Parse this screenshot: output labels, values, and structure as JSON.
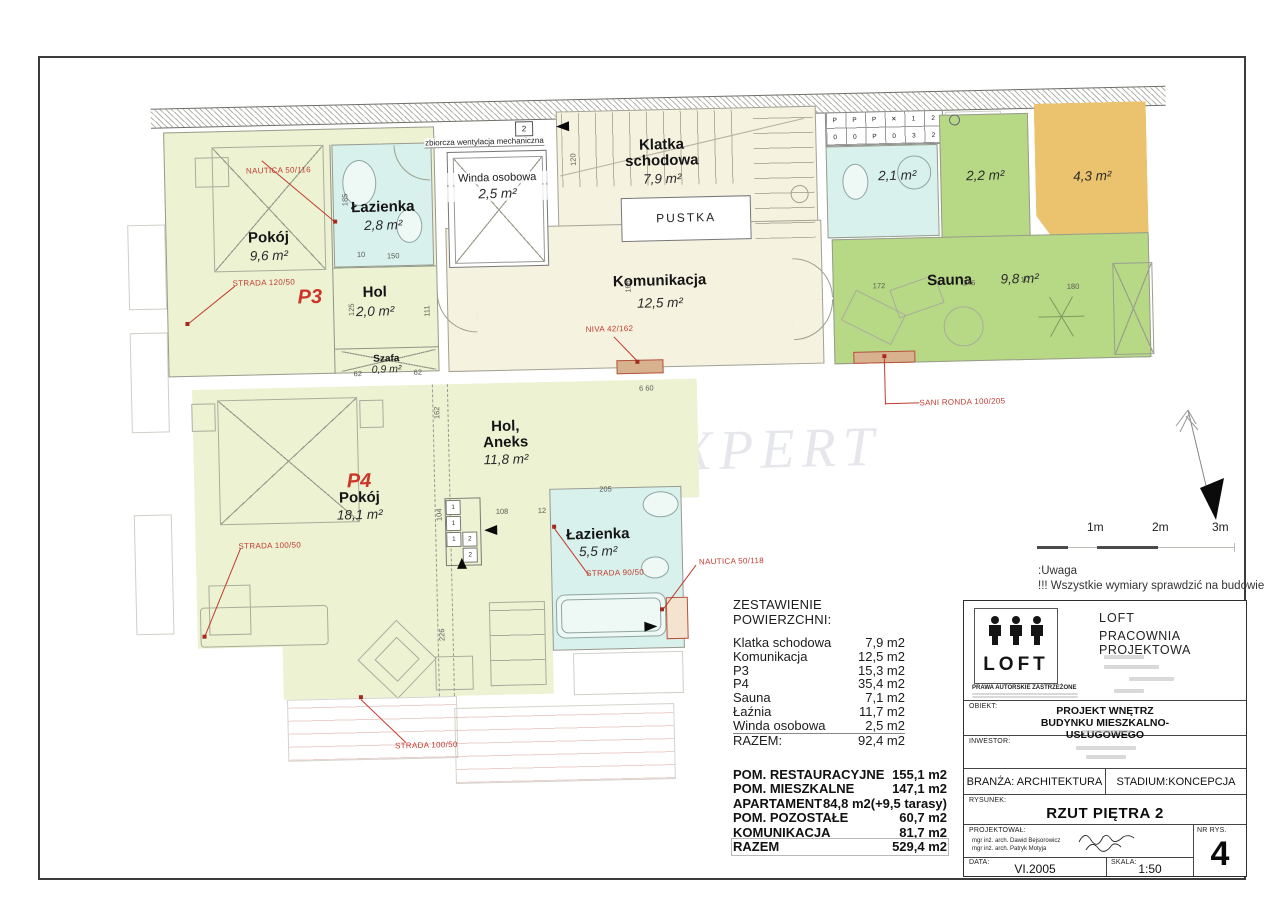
{
  "plan": {
    "watermark": "ON'S EXPERT",
    "watermark2": "S",
    "vent": {
      "label": "zbiorcza wentylacja mechaniczna",
      "box": "2"
    },
    "rooms": {
      "p3": {
        "code": "P3",
        "pokoj": {
          "name": "Pokój",
          "area": "9,6 m²"
        },
        "lazienka": {
          "name": "Łazienka",
          "area": "2,8 m²"
        },
        "hol": {
          "name": "Hol",
          "area": "2,0 m²"
        },
        "szafa": {
          "name": "Szafa",
          "area": "0,9 m²"
        }
      },
      "winda": {
        "name": "Winda osobowa",
        "area": "2,5 m²"
      },
      "klatka": {
        "name1": "Klatka",
        "name2": "schodowa",
        "area": "7,9 m²"
      },
      "pustka": "PUSTKA",
      "komunikacja": {
        "name": "Komunikacja",
        "area": "12,5 m²"
      },
      "wc": {
        "area": "2,1 m²"
      },
      "natryski": {
        "area": "2,2 m²"
      },
      "taras": {
        "area": "4,3 m²"
      },
      "sauna": {
        "name": "Sauna",
        "area": "9,8 m²"
      },
      "p4": {
        "code": "P4",
        "pokoj": {
          "name": "Pokój",
          "area": "18,1 m²"
        },
        "hol": {
          "name1": "Hol,",
          "name2": "Aneks",
          "area": "11,8 m²"
        },
        "lazienka": {
          "name": "Łazienka",
          "area": "5,5 m²"
        }
      }
    },
    "red_labels": [
      "NAUTICA 50/116",
      "STRADA 120/50",
      "NIVA 42/162",
      "SANI RONDA 100/205",
      "STRADA 100/50",
      "STRADA 90/50",
      "NAUTICA 50/118",
      "STRADA 100/50"
    ],
    "washer": [
      [
        "P",
        "P",
        "P",
        "✕",
        "1",
        "2"
      ],
      [
        "0",
        "0",
        "P",
        "0",
        "3",
        "2"
      ]
    ],
    "kitchen_cells": [
      "1",
      "1",
      "1",
      "2",
      "2"
    ],
    "dims": [
      "185",
      "150",
      "10",
      "125",
      "111",
      "62",
      "62",
      "120",
      "166",
      "172",
      "146",
      "10",
      "180",
      "162",
      "104",
      "226",
      "108",
      "12",
      "205",
      "6  60"
    ]
  },
  "scale_bar": {
    "labels": [
      "1m",
      "2m",
      "3m"
    ]
  },
  "note": {
    "line1": ":Uwaga",
    "line2": "!!! Wszystkie wymiary sprawdzić na budowie"
  },
  "areas_table": {
    "title": "ZESTAWIENIE POWIERZCHNI:",
    "rows": [
      {
        "label": "Klatka schodowa",
        "value": "7,9 m2"
      },
      {
        "label": "Komunikacja",
        "value": "12,5 m2"
      },
      {
        "label": "P3",
        "value": "15,3 m2"
      },
      {
        "label": "P4",
        "value": "35,4 m2"
      },
      {
        "label": "Sauna",
        "value": "7,1 m2"
      },
      {
        "label": "Łaźnia",
        "value": "11,7 m2"
      },
      {
        "label": "Winda osobowa",
        "value": "2,5 m2"
      },
      {
        "label": "RAZEM:",
        "value": "92,4 m2"
      }
    ]
  },
  "summary_table": {
    "rows": [
      {
        "label": "POM. RESTAURACYJNE",
        "value": "155,1 m2"
      },
      {
        "label": "POM. MIESZKALNE",
        "value": "147,1 m2"
      },
      {
        "label": "APARTAMENT",
        "value": "84,8 m2(+9,5 tarasy)"
      },
      {
        "label": "POM. POZOSTAŁE",
        "value": "60,7 m2"
      },
      {
        "label": "KOMUNIKACJA",
        "value": "81,7 m2"
      },
      {
        "label": "RAZEM",
        "value": "529,4 m2"
      }
    ]
  },
  "title_block": {
    "logo_text": "LOFT",
    "rights": "PRAWA AUTORSKIE ZASTRZEŻONE",
    "studio_line1": "LOFT",
    "studio_line2": "PRACOWNIA  PROJEKTOWA",
    "obiekt_label": "OBIEKT:",
    "obiekt_line1": "PROJEKT WNĘTRZ",
    "obiekt_line2": "BUDYNKU MIESZKALNO-USŁUGOWEGO",
    "inwestor_label": "INWESTOR:",
    "branza": "BRANŻA: ARCHITEKTURA",
    "stadium": "STADIUM:KONCEPCJA",
    "rysunek_label": "RYSUNEK:",
    "rysunek_value": "RZUT PIĘTRA 2",
    "projektowal_label": "PROJEKTOWAŁ:",
    "designer1": "mgr inż. arch. Dawid Bejsorowicz",
    "designer2": "mgr inż. arch. Patryk Motyja",
    "nr_rys_label": "NR RYS.",
    "nr_rys_value": "4",
    "data_label": "DATA:",
    "data_value": "VI.2005",
    "skala_label": "SKALA:",
    "skala_value": "1:50"
  }
}
